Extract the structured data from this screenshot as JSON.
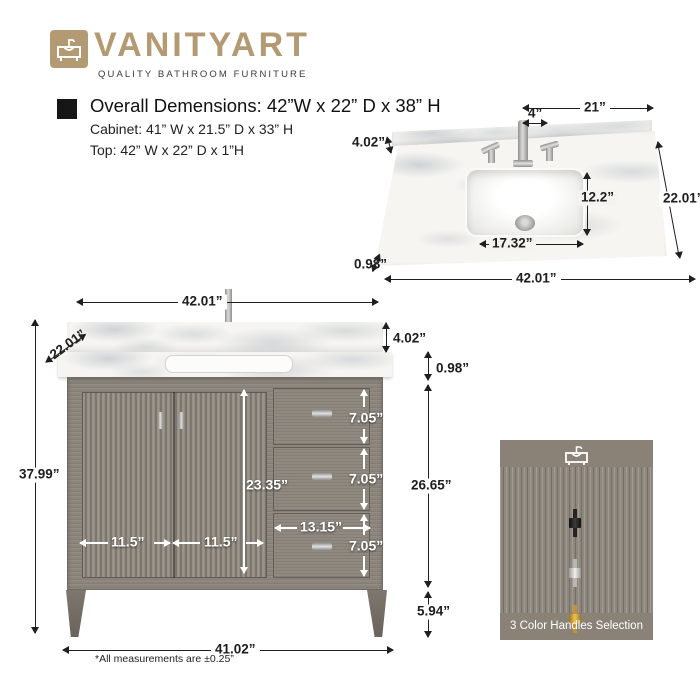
{
  "brand": {
    "name": "VANITYART",
    "tagline": "QUALITY BATHROOM FURNITURE",
    "gold_color": "#b49a72"
  },
  "specs": {
    "overall": "Overall Demensions: 42”W x 22” D x 38” H",
    "cabinet": "Cabinet: 41” W x 21.5” D x 33” H",
    "top": "Top: 42” W x 22” D x 1”H"
  },
  "counter": {
    "half_width": "21”",
    "spread": "4”",
    "splash": "4.02”",
    "sink_depth": "12.2”",
    "depth": "22.01”",
    "sink_width": "17.32”",
    "thickness": "0.98”",
    "width": "42.01”"
  },
  "front": {
    "width_top": "42.01”",
    "depth": "22.01”",
    "splash": "4.02”",
    "thickness": "0.98”",
    "height": "37.99”",
    "door_opening": "23.35”",
    "door_left": "11.5”",
    "door_right": "11.5”",
    "drawer_width": "13.15”",
    "drawer1": "7.05”",
    "drawer2": "7.05”",
    "drawer3": "7.05”",
    "body": "26.65”",
    "leg": "5.94”",
    "width_base": "41.02”"
  },
  "handles": {
    "title": "3 Color Handles Selection",
    "options": [
      {
        "name": "black",
        "color": "#242424"
      },
      {
        "name": "chrome",
        "color": "#c9c9c7"
      },
      {
        "name": "gold",
        "color": "#c2932f"
      }
    ]
  },
  "footnote": "*All measurements are ±0.25”"
}
